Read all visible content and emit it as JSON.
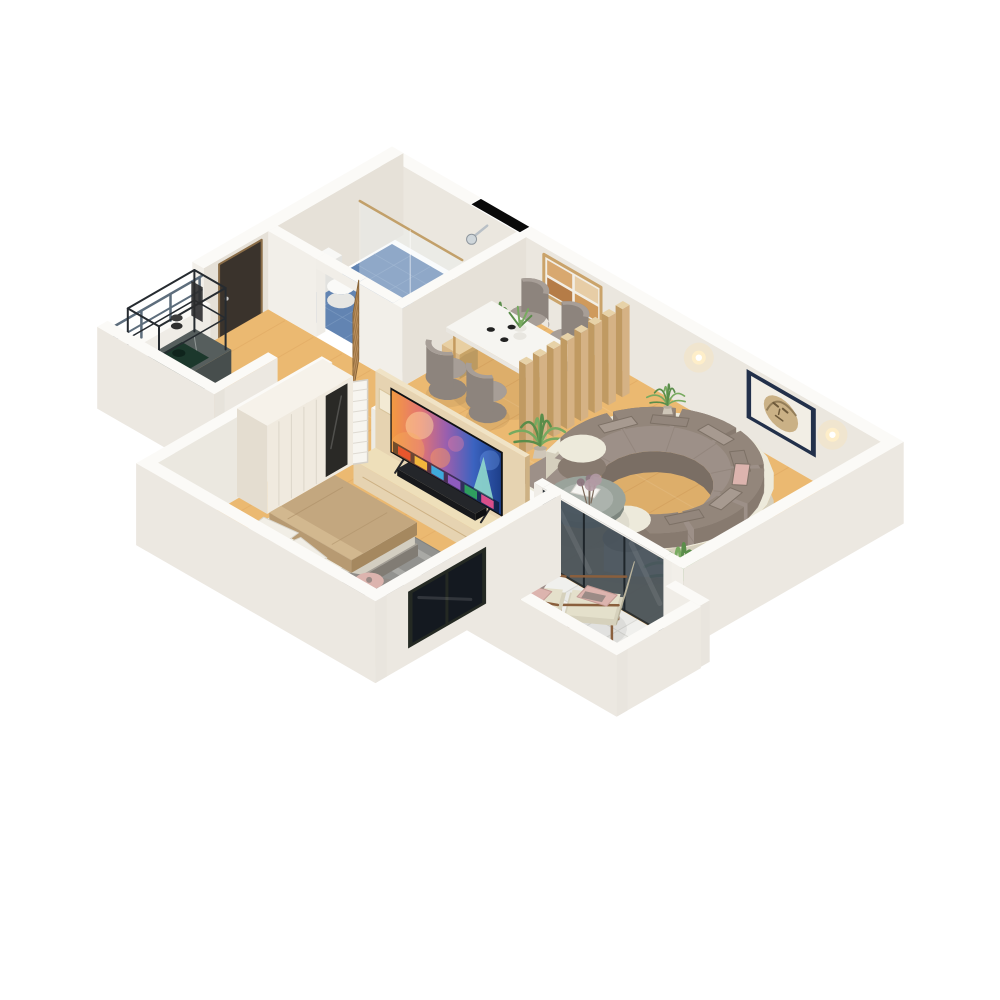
{
  "scene": {
    "title": "3d-apartment-floor-plan-render",
    "view": "isometric-cutaway",
    "background": "#ffffff"
  },
  "palette": {
    "wallTop": "#fbfaf7",
    "wallIn": "#ebe7df",
    "wallIn2": "#e6e1d8",
    "wallLight": "#f2efe9",
    "wallExt": "#ece8e1",
    "wood": "#ebb971",
    "woodLine": "#d2934e",
    "woodLine2": "#f7d9a8",
    "bathFloor": "#6284b2",
    "bathTileLine": "#7e9cc2",
    "duck": "#c9a265",
    "duckLine": "#8a6a3c",
    "gold": "#c2a06a",
    "doorWood": "#bd9160",
    "entryDoor": "#3a332c",
    "counterTop": "#565e5d",
    "counterFace": "#474e4d",
    "stove": "#1c382c",
    "metal": "#262b30",
    "rail": "#5d6d7c",
    "tile": "#eaeae7",
    "tileLine": "#d9d9d5",
    "tileCheck": "#f4f4f2",
    "divider": "#d5b285",
    "dividerSide": "#c09a62",
    "dividerTop": "#e7d2a8",
    "chair": "#a79e97",
    "chairDark": "#8d847d",
    "shell": "#edeadb",
    "shellSide": "#d5cfbd",
    "sofaSeat": "#9d9088",
    "sofaDark": "#7a6e64",
    "sofaBack": "#93867b",
    "sofaBack2": "#877a6f",
    "pink": "#dcb4ae",
    "pinkD": "#c49b95",
    "mauve": "#9b8b86",
    "marble": "#9aa39b",
    "marbleD": "#7d867f",
    "artFrame": "#caa36a",
    "artNavy": "#22304a",
    "artMat": "#f2eee5",
    "artFace": "#c7ab7e",
    "artInk": "#6e5a3b",
    "rug": "#92928f",
    "rugLight": "#b9b9b4",
    "pillow": "#f1eee6",
    "blanketTop": "#c3a77f",
    "blanket": "#b79a72",
    "blanketD": "#a5885f",
    "blanketFold": "#d2b88f",
    "mattressTop": "#edeade",
    "mattress": "#e0dbce",
    "mattressD": "#d3cec1",
    "bedBaseTop": "#a39e95",
    "bedBase": "#8f8a82",
    "bedBaseD": "#817c74",
    "wood2": "#e6d3b1",
    "wood2D": "#cdb184",
    "wood2Top": "#f0e3c6",
    "wardrobe": "#f0eadf",
    "wardrobeSide": "#e4ddd0",
    "wardrobeTop": "#f6f2ea",
    "mirror": "#2a2926",
    "glassDark": "#46525c",
    "frameDark": "#242923",
    "winGlass": "#141920",
    "green": "#5a8d4a",
    "green2": "#78aa60",
    "pot": "#cfc6b8",
    "pot2": "#b8ae9e",
    "tvBezel": "#101114",
    "soundbar": "#17181a",
    "bchairSeat": "#d6d1bc",
    "bchairSeatTop": "#e4e0cb",
    "bchairBack": "#dcd8c3",
    "bchairWood": "#8a5f3d",
    "tableTop": "#f6f5f1",
    "tableSide": "#e9e6e0",
    "tableSideD": "#dfdcd5",
    "legWood": "#c49a5e",
    "shadow": "rgba(0,0,0,0.06)"
  },
  "tv": {
    "screen_gradient": [
      "#f39a41",
      "#e5766f",
      "#9a5fae",
      "#3b63c0",
      "#1d3f8a"
    ],
    "app_tile_colors": [
      "#e8562d",
      "#f2b63c",
      "#3fa9dc",
      "#8e5bbf",
      "#2f9e5f",
      "#d84f8a"
    ]
  },
  "rooms": [
    {
      "name": "bathroom",
      "items": [
        {
          "name": "walk-in-shower"
        },
        {
          "name": "glass-partition"
        },
        {
          "name": "shower-head"
        },
        {
          "name": "wooden-duckboard"
        },
        {
          "name": "toilet"
        },
        {
          "name": "black-skylight-window"
        },
        {
          "name": "blue-tile-floor"
        },
        {
          "name": "slatted-wood-door"
        }
      ]
    },
    {
      "name": "hallway",
      "items": [
        {
          "name": "entry-door"
        }
      ]
    },
    {
      "name": "kitchen",
      "items": [
        {
          "name": "stone-counter"
        },
        {
          "name": "dark-green-cooktop"
        },
        {
          "name": "black-metal-shelf-frame"
        },
        {
          "name": "built-in-oven"
        },
        {
          "name": "french-balcony-railing"
        }
      ]
    },
    {
      "name": "dining-area",
      "items": [
        {
          "name": "dining-table"
        },
        {
          "name": "dining-chair",
          "count": 4
        },
        {
          "name": "table-plant"
        },
        {
          "name": "cup",
          "count": 3
        },
        {
          "name": "warm-collage-artwork"
        },
        {
          "name": "wood-slat-room-divider",
          "slats": 8
        },
        {
          "name": "potted-palm",
          "count": 2
        },
        {
          "name": "wooden-side-cube"
        }
      ]
    },
    {
      "name": "living-room",
      "items": [
        {
          "name": "curved-sectional-sofa"
        },
        {
          "name": "sofa-pillow",
          "count": 6
        },
        {
          "name": "pink-floral-pillow"
        },
        {
          "name": "round-marble-coffee-table"
        },
        {
          "name": "dried-flower-arrangement"
        },
        {
          "name": "books"
        },
        {
          "name": "portrait-artwork-navy-frame"
        },
        {
          "name": "wall-sconce",
          "count": 2
        },
        {
          "name": "potted-palm",
          "count": 2
        },
        {
          "name": "side-table-with-vase"
        }
      ]
    },
    {
      "name": "bedroom",
      "items": [
        {
          "name": "double-bed"
        },
        {
          "name": "bed-pillow",
          "count": 2
        },
        {
          "name": "tan-blanket"
        },
        {
          "name": "striped-gray-rug"
        },
        {
          "name": "wardrobe-with-mirror"
        },
        {
          "name": "slatted-white-door"
        },
        {
          "name": "media-wall"
        },
        {
          "name": "tv"
        },
        {
          "name": "soundbar"
        },
        {
          "name": "lounge-pouf"
        },
        {
          "name": "round-side-table"
        },
        {
          "name": "potted-plant",
          "count": 2
        },
        {
          "name": "dark-framed-window"
        }
      ]
    },
    {
      "name": "balcony",
      "items": [
        {
          "name": "wood-frame-armchair",
          "count": 2
        },
        {
          "name": "pink-pillow",
          "count": 2
        },
        {
          "name": "checkered-tile-floor"
        },
        {
          "name": "glass-sliding-doors"
        },
        {
          "name": "glass-balustrade"
        },
        {
          "name": "white-parapet"
        }
      ]
    }
  ]
}
